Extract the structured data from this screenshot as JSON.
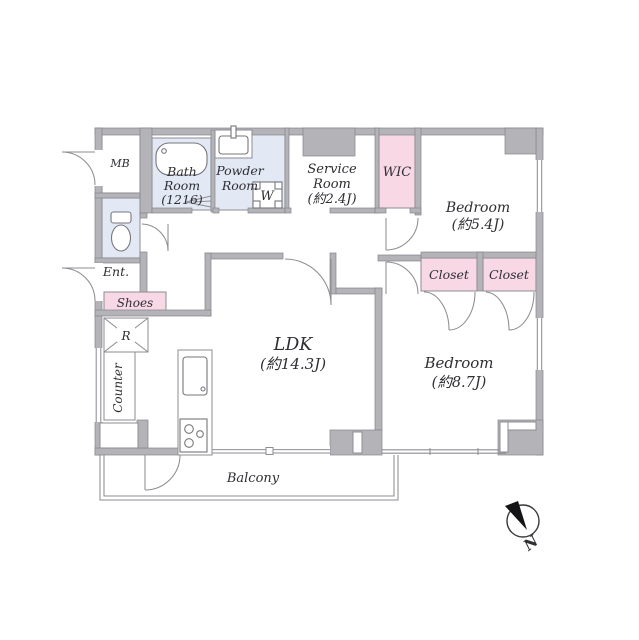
{
  "title": "apartment-floor-plan",
  "colors": {
    "wall": "#b3b3b8",
    "wet_room": "#e3e9f4",
    "storage_pink": "#f8d8e4",
    "line": "#8d8d93",
    "text": "#2e2e33"
  },
  "plan": {
    "mb": "MB",
    "bath": {
      "l1": "Bath",
      "l2": "Room",
      "l3": "(1216)"
    },
    "powder": {
      "l1": "Powder",
      "l2": "Room"
    },
    "washer": "W",
    "service": {
      "l1": "Service",
      "l2": "Room",
      "l3": "(約2.4J)"
    },
    "wic": "WIC",
    "bedroom_a": {
      "l1": "Bedroom",
      "l2": "(約5.4J)"
    },
    "closet_a": "Closet",
    "closet_b": "Closet",
    "bedroom_b": {
      "l1": "Bedroom",
      "l2": "(約8.7J)"
    },
    "ldk": {
      "l1": "LDK",
      "l2": "(約14.3J)"
    },
    "entrance": "Ent.",
    "shoes": "Shoes",
    "fridge": "R",
    "counter": "Counter",
    "balcony": "Balcony",
    "compass_north": "N"
  }
}
